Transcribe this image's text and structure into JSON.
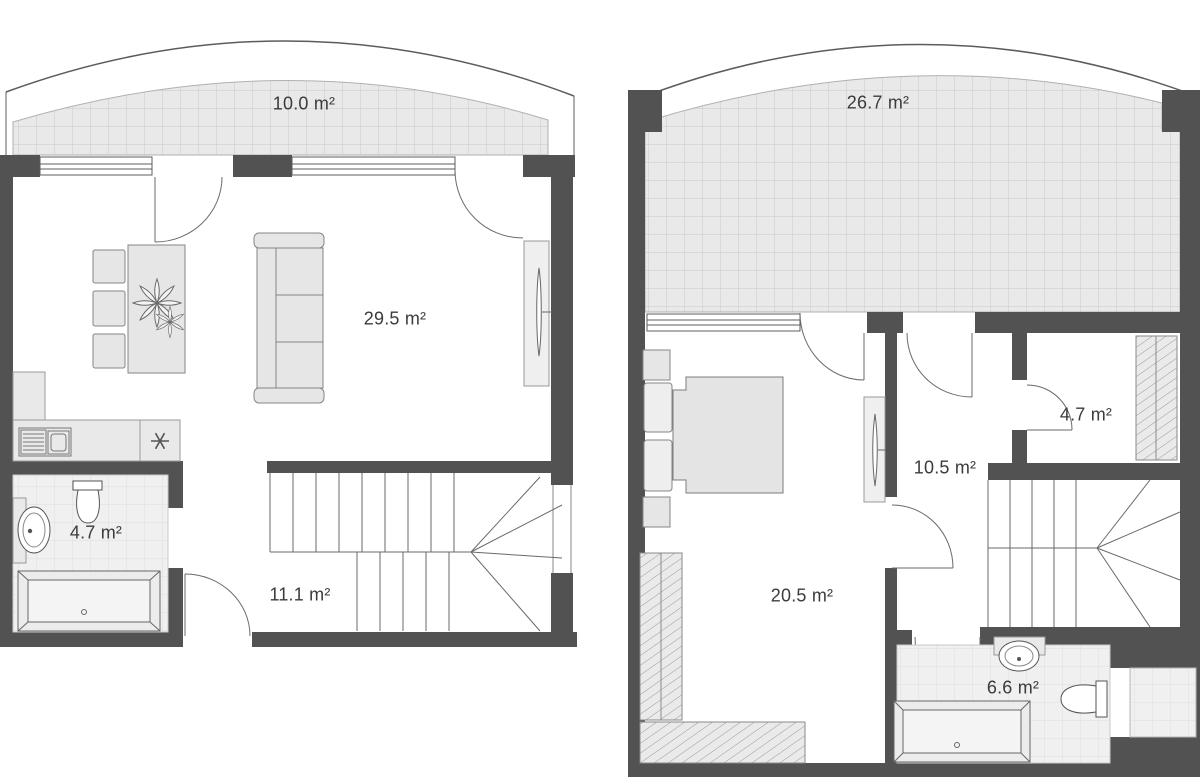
{
  "document": {
    "type": "floor-plan",
    "description_visible_text_only": true
  },
  "colors": {
    "wall": "#525252",
    "furniture_fill": "#e6e6e6",
    "furniture_stroke": "#858585",
    "terrace_fill": "#e9e9e9",
    "terrace_grid": "#c9c9c9",
    "tile_fill": "#f0f0f0",
    "tile_grid": "#dedede",
    "thin_line": "#5c5c5c",
    "label_text": "#3b3b3b",
    "background": "#ffffff"
  },
  "floor1": {
    "terrace": "10.0 m²",
    "living": "29.5 m²",
    "bathroom": "4.7 m²",
    "hallway": "11.1 m²"
  },
  "floor2": {
    "terrace": "26.7 m²",
    "bedroom": "20.5 m²",
    "hallway": "10.5 m²",
    "closet": "4.7 m²",
    "bathroom": "6.6 m²"
  }
}
